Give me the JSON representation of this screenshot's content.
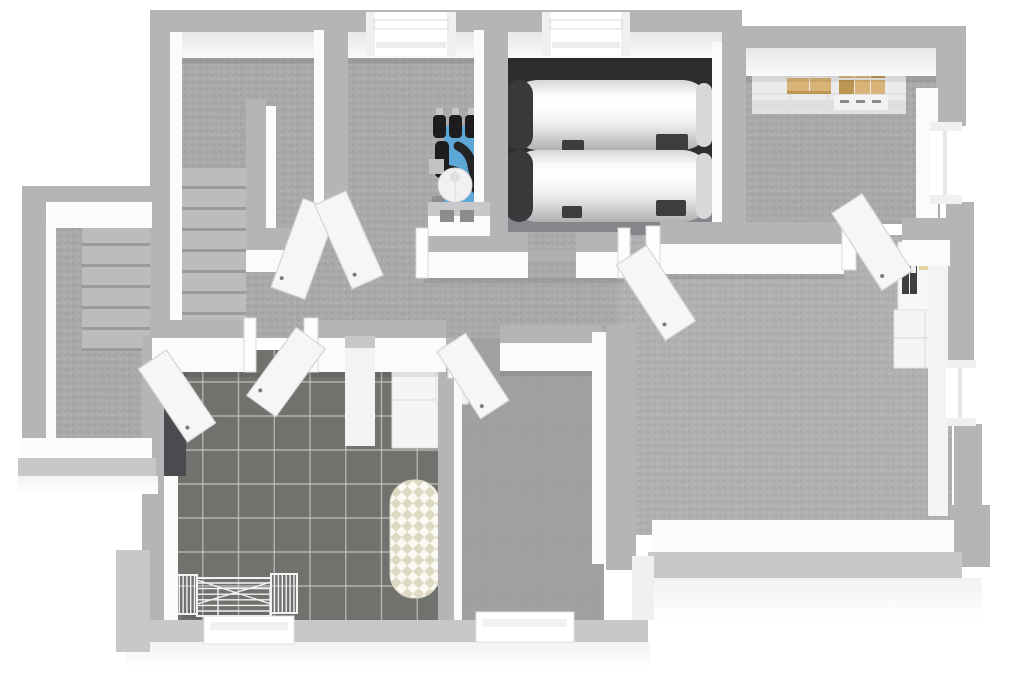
{
  "meta": {
    "title": "3D basement floor plan rendering",
    "view": "top-down dollhouse perspective",
    "has_text": false
  },
  "colors": {
    "bg": "#ffffff",
    "wall_cap": "#b5b5b7",
    "wall_cap_light": "#c8c8ca",
    "wall_face": "#fbfbfc",
    "floor_main": "#a9a9ab",
    "floor_large": "#b0b0b2",
    "floor_middle": "#9d9d9f",
    "floor_dark": "#2e2e30",
    "floor_tank_strip": "#86868a",
    "tile": "#6f726d",
    "grout": "#c9c9c9",
    "step": "#bcbcbe",
    "step_shadow": "#9b9b9e",
    "door": "#f6f6f7",
    "door_edge": "#d5d5d7",
    "handle": "#7c7c7f",
    "window_glass": "#ffffff",
    "window_frame": "#f0f0f2",
    "tank_cap": "#39393b",
    "tank_strap": "#3d3d3f",
    "boiler_blue": "#5ea8d8",
    "boiler_blue_dark": "#4186b4",
    "pipe_black": "#242426",
    "vessel_black": "#1d1d1f",
    "metal_silver": "#c7c7c9",
    "box_tan": "#d8b377",
    "box_tan_dark": "#bd9652",
    "bin_white": "#f2f2f3",
    "binder_dark": "#3f3f41",
    "label_tan": "#e4d3a0",
    "iron_base": "#faf9f2",
    "iron_check": "#ddd9c3",
    "rack_wire": "#f3f3f4"
  },
  "rooms": [
    {
      "id": "staircase-hall",
      "name": "Staircase hall with interior stair flight"
    },
    {
      "id": "exterior-stairwell",
      "name": "Exterior basement stairwell"
    },
    {
      "id": "technical-room",
      "name": "Technical room with boiler unit"
    },
    {
      "id": "tank-room",
      "name": "Tank room with two storage tanks"
    },
    {
      "id": "storage-room",
      "name": "Storage room with shelving"
    },
    {
      "id": "corridor",
      "name": "Central corridor"
    },
    {
      "id": "laundry-room",
      "name": "Laundry room with tiled floor"
    },
    {
      "id": "hobby-room",
      "name": "Small bottom-middle room"
    },
    {
      "id": "large-room",
      "name": "Large basement room"
    }
  ],
  "objects": [
    {
      "id": "storage-tank-1",
      "name": "Horizontal white storage tank"
    },
    {
      "id": "storage-tank-2",
      "name": "Horizontal white storage tank"
    },
    {
      "id": "boiler-unit",
      "name": "Blue wall-mounted heating unit with black pipes"
    },
    {
      "id": "expansion-vessels",
      "name": "Three black expansion vessels",
      "count": 3
    },
    {
      "id": "water-softener",
      "name": "White cylindrical vessel"
    },
    {
      "id": "storage-shelf",
      "name": "White shelving with cardboard boxes"
    },
    {
      "id": "binder-shelf",
      "name": "Small shelf with binders"
    },
    {
      "id": "side-cabinet",
      "name": "White cabinet"
    },
    {
      "id": "laundry-cabinet",
      "name": "White corner cabinet"
    },
    {
      "id": "ironing-board",
      "name": "Checkered ironing board"
    },
    {
      "id": "drying-rack",
      "name": "Folding wire drying rack"
    }
  ],
  "stairs": {
    "hall_flight_steps": 8,
    "exterior_flight_steps": 7
  },
  "laundry": {
    "tile_grid": {
      "cols": 8,
      "rows": 8
    }
  },
  "drying_rack": {
    "center_wires": 6,
    "wing_wires": 6
  },
  "windows": {
    "count": 6
  },
  "doors": {
    "count": 7
  },
  "wall_vents": {
    "count": 2
  }
}
